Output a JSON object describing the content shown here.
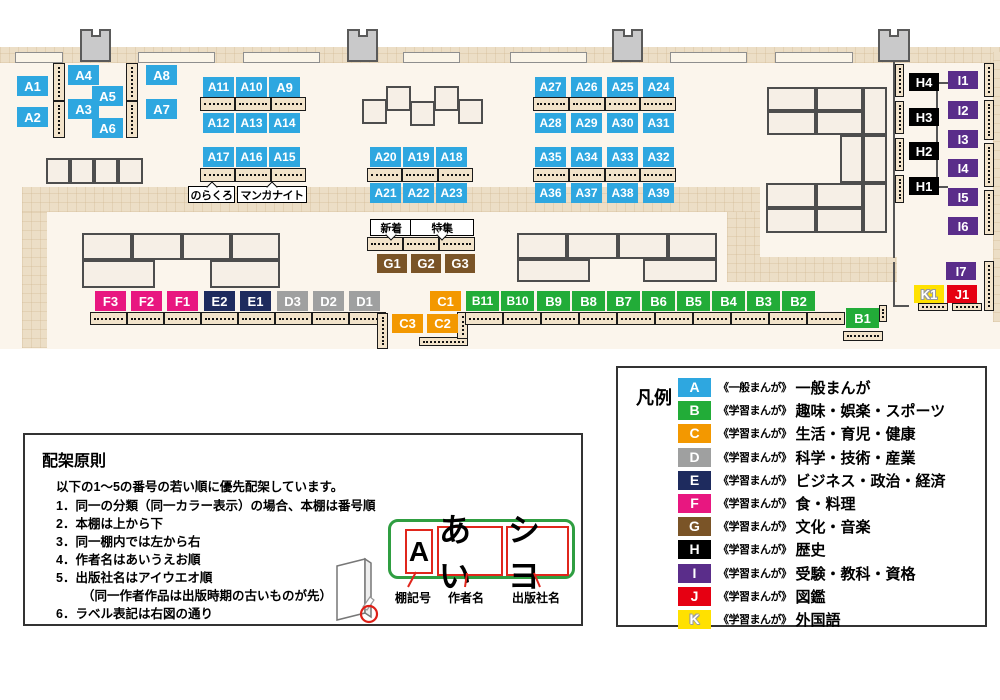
{
  "categories": [
    {
      "code": "A",
      "color": "#2ea7e0",
      "series": "《一般まんが》",
      "label": "一般まんが"
    },
    {
      "code": "B",
      "color": "#22ac38",
      "series": "《学習まんが》",
      "label": "趣味・娯楽・スポーツ"
    },
    {
      "code": "C",
      "color": "#f39800",
      "series": "《学習まんが》",
      "label": "生活・育児・健康"
    },
    {
      "code": "D",
      "color": "#9fa0a0",
      "series": "《学習まんが》",
      "label": "科学・技術・産業"
    },
    {
      "code": "E",
      "color": "#1e2b5e",
      "series": "《学習まんが》",
      "label": "ビジネス・政治・経済"
    },
    {
      "code": "F",
      "color": "#e81780",
      "series": "《学習まんが》",
      "label": "食・料理"
    },
    {
      "code": "G",
      "color": "#7a5427",
      "series": "《学習まんが》",
      "label": "文化・音楽"
    },
    {
      "code": "H",
      "color": "#000000",
      "series": "《学習まんが》",
      "label": "歴史"
    },
    {
      "code": "I",
      "color": "#5a2d8a",
      "series": "《学習まんが》",
      "label": "受験・教科・資格"
    },
    {
      "code": "J",
      "color": "#e60012",
      "series": "《学習まんが》",
      "label": "図鑑"
    },
    {
      "code": "K",
      "color": "#ffe100",
      "series": "《学習まんが》",
      "label": "外国語"
    }
  ],
  "legend": {
    "title": "凡例"
  },
  "map": {
    "shelf_labels": [
      {
        "t": "A1",
        "x": 17,
        "y": 76
      },
      {
        "t": "A2",
        "x": 17,
        "y": 107
      },
      {
        "t": "A4",
        "x": 68,
        "y": 65
      },
      {
        "t": "A5",
        "x": 92,
        "y": 86
      },
      {
        "t": "A3",
        "x": 68,
        "y": 99
      },
      {
        "t": "A6",
        "x": 92,
        "y": 118
      },
      {
        "t": "A8",
        "x": 146,
        "y": 65
      },
      {
        "t": "A7",
        "x": 146,
        "y": 99
      },
      {
        "t": "A11",
        "x": 203,
        "y": 77
      },
      {
        "t": "A10",
        "x": 236,
        "y": 77
      },
      {
        "t": "A9",
        "x": 269,
        "y": 77
      },
      {
        "t": "A12",
        "x": 203,
        "y": 113
      },
      {
        "t": "A13",
        "x": 236,
        "y": 113
      },
      {
        "t": "A14",
        "x": 269,
        "y": 113
      },
      {
        "t": "A17",
        "x": 203,
        "y": 147
      },
      {
        "t": "A16",
        "x": 236,
        "y": 147
      },
      {
        "t": "A15",
        "x": 269,
        "y": 147
      },
      {
        "t": "A20",
        "x": 370,
        "y": 147
      },
      {
        "t": "A19",
        "x": 403,
        "y": 147
      },
      {
        "t": "A18",
        "x": 436,
        "y": 147
      },
      {
        "t": "A21",
        "x": 370,
        "y": 183
      },
      {
        "t": "A22",
        "x": 403,
        "y": 183
      },
      {
        "t": "A23",
        "x": 436,
        "y": 183
      },
      {
        "t": "A27",
        "x": 535,
        "y": 77
      },
      {
        "t": "A26",
        "x": 571,
        "y": 77
      },
      {
        "t": "A25",
        "x": 607,
        "y": 77
      },
      {
        "t": "A24",
        "x": 643,
        "y": 77
      },
      {
        "t": "A28",
        "x": 535,
        "y": 113
      },
      {
        "t": "A29",
        "x": 571,
        "y": 113
      },
      {
        "t": "A30",
        "x": 607,
        "y": 113
      },
      {
        "t": "A31",
        "x": 643,
        "y": 113
      },
      {
        "t": "A35",
        "x": 535,
        "y": 147
      },
      {
        "t": "A34",
        "x": 571,
        "y": 147
      },
      {
        "t": "A33",
        "x": 607,
        "y": 147
      },
      {
        "t": "A32",
        "x": 643,
        "y": 147
      },
      {
        "t": "A36",
        "x": 535,
        "y": 183
      },
      {
        "t": "A37",
        "x": 571,
        "y": 183
      },
      {
        "t": "A38",
        "x": 607,
        "y": 183
      },
      {
        "t": "A39",
        "x": 643,
        "y": 183
      },
      {
        "t": "G1",
        "x": 377,
        "y": 254,
        "w": 30,
        "h": 19
      },
      {
        "t": "G2",
        "x": 411,
        "y": 254,
        "w": 30,
        "h": 19
      },
      {
        "t": "G3",
        "x": 445,
        "y": 254,
        "w": 30,
        "h": 19
      },
      {
        "t": "F3",
        "x": 95,
        "y": 291
      },
      {
        "t": "F2",
        "x": 131,
        "y": 291
      },
      {
        "t": "F1",
        "x": 167,
        "y": 291
      },
      {
        "t": "E2",
        "x": 204,
        "y": 291
      },
      {
        "t": "E1",
        "x": 240,
        "y": 291
      },
      {
        "t": "D3",
        "x": 277,
        "y": 291
      },
      {
        "t": "D2",
        "x": 313,
        "y": 291
      },
      {
        "t": "D1",
        "x": 349,
        "y": 291
      },
      {
        "t": "C1",
        "x": 430,
        "y": 291
      },
      {
        "t": "C3",
        "x": 392,
        "y": 314,
        "h": 19
      },
      {
        "t": "C2",
        "x": 427,
        "y": 314,
        "h": 19
      },
      {
        "t": "B11",
        "x": 466,
        "y": 291,
        "w": 33
      },
      {
        "t": "B10",
        "x": 501,
        "y": 291,
        "w": 33
      },
      {
        "t": "B9",
        "x": 537,
        "y": 291,
        "w": 33
      },
      {
        "t": "B8",
        "x": 572,
        "y": 291,
        "w": 33
      },
      {
        "t": "B7",
        "x": 607,
        "y": 291,
        "w": 33
      },
      {
        "t": "B6",
        "x": 642,
        "y": 291,
        "w": 33
      },
      {
        "t": "B5",
        "x": 677,
        "y": 291,
        "w": 33
      },
      {
        "t": "B4",
        "x": 712,
        "y": 291,
        "w": 33
      },
      {
        "t": "B3",
        "x": 747,
        "y": 291,
        "w": 33
      },
      {
        "t": "B2",
        "x": 782,
        "y": 291,
        "w": 33
      },
      {
        "t": "B1",
        "x": 846,
        "y": 308,
        "w": 33
      },
      {
        "t": "H4",
        "x": 909,
        "y": 73,
        "w": 30,
        "h": 18
      },
      {
        "t": "H3",
        "x": 909,
        "y": 108,
        "w": 30,
        "h": 18
      },
      {
        "t": "H2",
        "x": 909,
        "y": 142,
        "w": 30,
        "h": 18
      },
      {
        "t": "H1",
        "x": 909,
        "y": 177,
        "w": 30,
        "h": 18
      },
      {
        "t": "I1",
        "x": 948,
        "y": 71,
        "w": 30,
        "h": 18
      },
      {
        "t": "I2",
        "x": 948,
        "y": 101,
        "w": 30,
        "h": 18
      },
      {
        "t": "I3",
        "x": 948,
        "y": 130,
        "w": 30,
        "h": 18
      },
      {
        "t": "I4",
        "x": 948,
        "y": 159,
        "w": 30,
        "h": 18
      },
      {
        "t": "I5",
        "x": 948,
        "y": 188,
        "w": 30,
        "h": 18
      },
      {
        "t": "I6",
        "x": 948,
        "y": 217,
        "w": 30,
        "h": 18
      },
      {
        "t": "I7",
        "x": 946,
        "y": 262,
        "w": 30,
        "h": 18
      },
      {
        "t": "K1",
        "x": 914,
        "y": 285,
        "w": 30,
        "h": 18
      },
      {
        "t": "J1",
        "x": 947,
        "y": 285,
        "w": 30,
        "h": 18
      }
    ],
    "sign_labels": [
      {
        "t": "のらくろ",
        "x": 188,
        "y": 186,
        "w": 47,
        "tail": "up"
      },
      {
        "t": "マンガナイト",
        "x": 237,
        "y": 186,
        "w": 70,
        "tail": "up"
      },
      {
        "t": "新着",
        "x": 370,
        "y": 219,
        "w": 42,
        "tail": "down"
      },
      {
        "t": "特集",
        "x": 410,
        "y": 219,
        "w": 64,
        "tail": "down"
      }
    ]
  },
  "principles": {
    "title": "配架原則",
    "intro": "以下の1～5の番号の若い順に優先配架しています。",
    "items": [
      {
        "text": "1．同一の分類（同一カラー表示）の場合、本棚は番号順"
      },
      {
        "text": "2．本棚は上から下"
      },
      {
        "text": "3．同一棚内では左から右"
      },
      {
        "text": "4．作者名はあいうえお順"
      },
      {
        "text": "5．出版社名はアイウエオ順"
      },
      {
        "text": "（同一作者作品は出版時期の古いものが先）",
        "indent": true
      },
      {
        "text": "6．ラベル表記は右図の通り"
      }
    ],
    "label_example": {
      "parts": [
        "A",
        "あい",
        "シヨ"
      ],
      "captions": [
        "棚記号",
        "作者名",
        "出版社名"
      ]
    }
  }
}
